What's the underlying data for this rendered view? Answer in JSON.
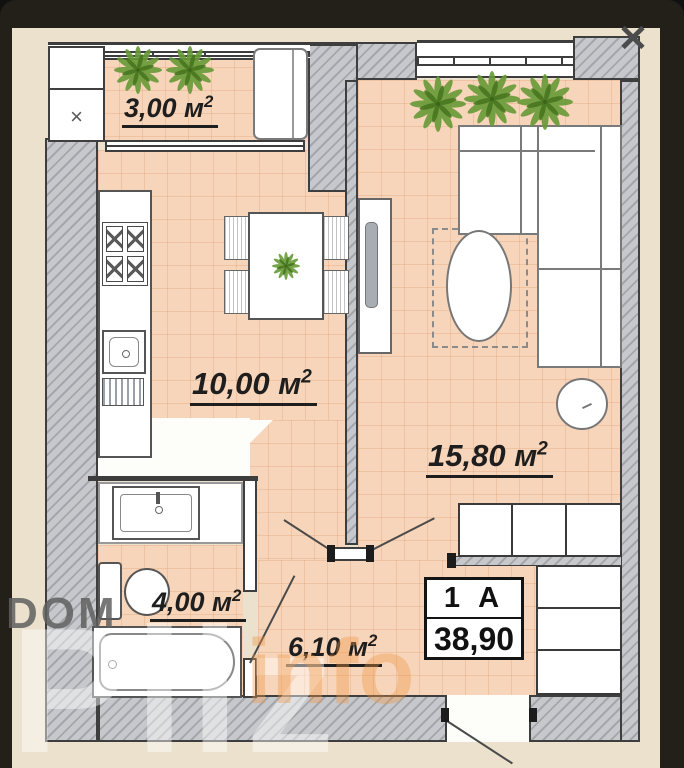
{
  "window_overlay": {
    "close_icon": "✕"
  },
  "watermark": {
    "brand_top": "DOM",
    "brand_main": "Pliz",
    "brand_suffix": "info"
  },
  "floor_plan": {
    "unit_box": {
      "unit_name": "1 А",
      "total_area": "38,90"
    },
    "rooms": [
      {
        "id": "balcony",
        "label": "3,00 м",
        "sup": "2"
      },
      {
        "id": "kitchen",
        "label": "10,00 м",
        "sup": "2"
      },
      {
        "id": "living_room",
        "label": "15,80 м",
        "sup": "2"
      },
      {
        "id": "bathroom",
        "label": "4,00 м",
        "sup": "2"
      },
      {
        "id": "hallway",
        "label": "6,10 м",
        "sup": "2"
      }
    ],
    "cabinet_mark": "×",
    "colors": {
      "background_dark": "#232019",
      "sheet_beige": "#ebe1cc",
      "floor_peach": "#f7d5ba",
      "wall_gray": "#c7c8cc",
      "plant_green": "#679a37",
      "label_ink": "#1e1e1e",
      "watermark_orange": "rgba(240,150,70,0.38)"
    }
  }
}
